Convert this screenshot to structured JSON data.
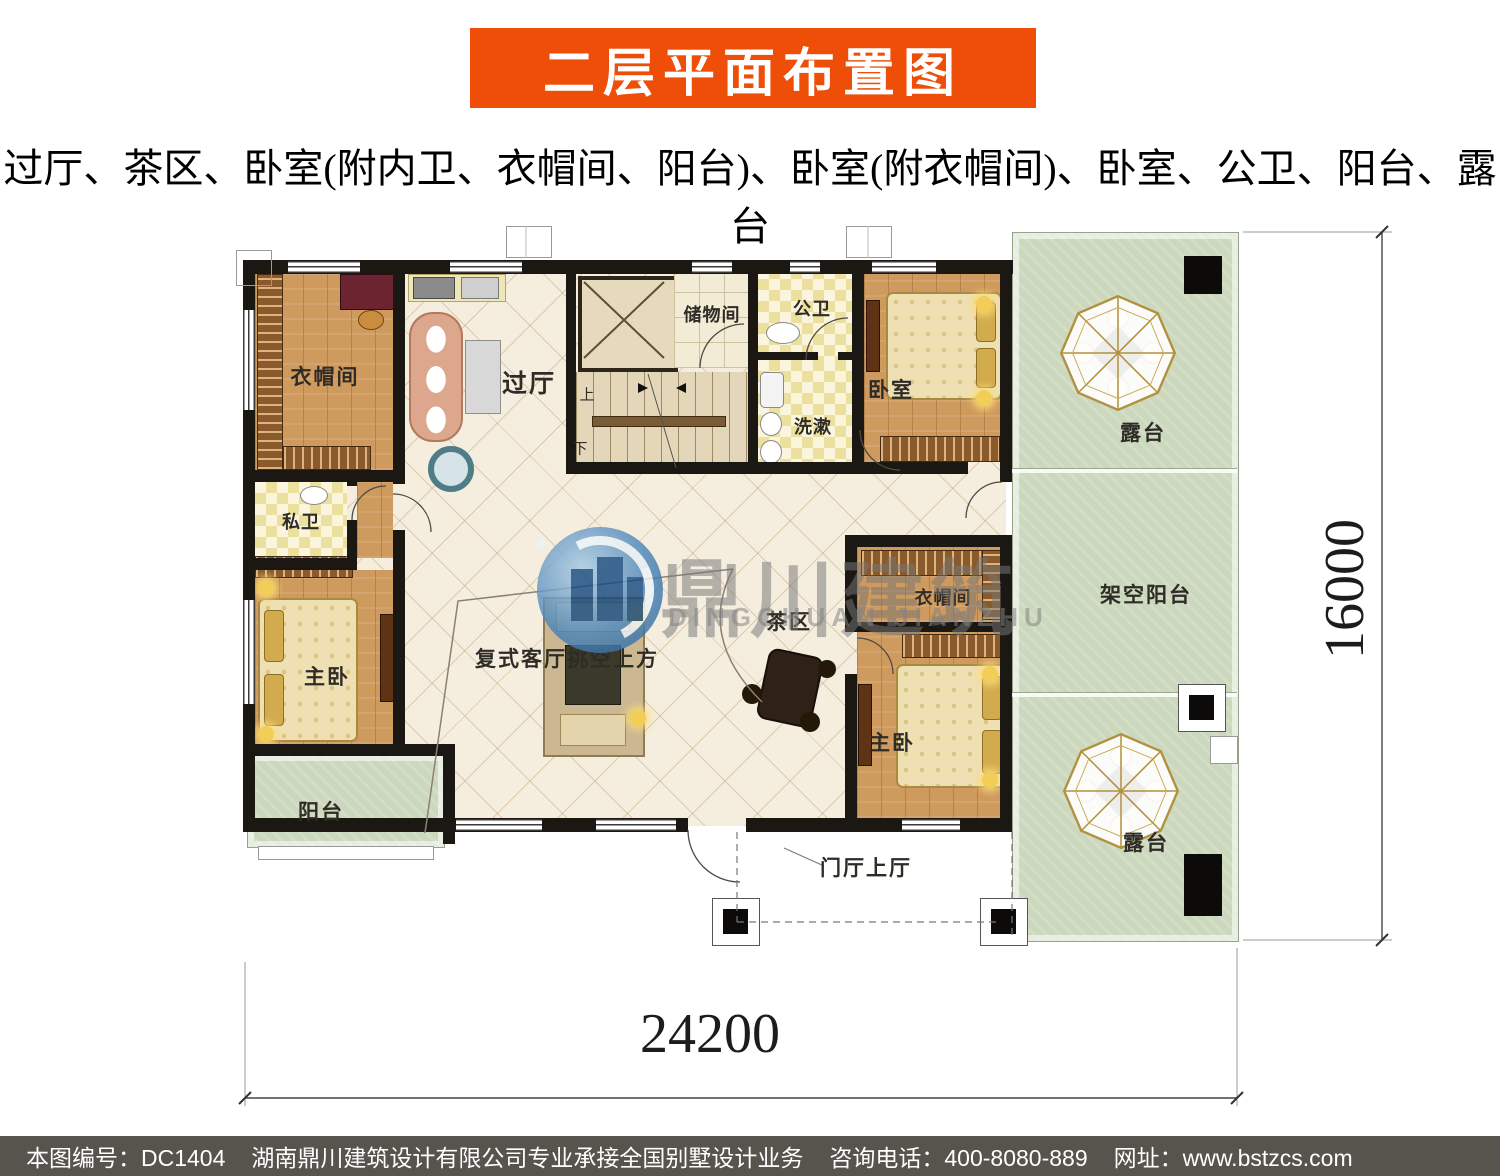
{
  "header": {
    "title": "二层平面布置图",
    "subtitle": "过厅、茶区、卧室(附内卫、衣帽间、阳台)、卧室(附衣帽间)、卧室、公卫、阳台、露台"
  },
  "plan": {
    "labels": {
      "cloakroom_tl": "衣帽间",
      "private_bath": "私卫",
      "master_left": "主卧",
      "hallway": "过厅",
      "storage": "储物间",
      "public_bath": "公卫",
      "wash": "洗漱",
      "bedroom_tr": "卧室",
      "terrace_top": "露台",
      "tea": "茶区",
      "void": "复式客厅挑空上方",
      "cloakroom_r": "衣帽间",
      "elevated_balcony": "架空阳台",
      "master_right": "主卧",
      "balcony": "阳台",
      "terrace_bottom": "露台",
      "entry_hall": "门厅上厅",
      "stair_up": "上",
      "stair_down": "下"
    },
    "dimensions": {
      "width_mm": "24200",
      "height_mm": "16000"
    }
  },
  "watermark": {
    "cn": "鼎川建筑",
    "en": "DINGCHUAN JIANZHU"
  },
  "footer": {
    "code": "本图编号：DC1404",
    "company": "湖南鼎川建筑设计有限公司专业承接全国别墅设计业务",
    "phone": "咨询电话：400-8080-889",
    "website": "网址：www.bstzcs.com"
  },
  "colors": {
    "banner": "#ee4e08",
    "footer_bg": "#57534d",
    "terrace_green": "#cbd8bd",
    "wood": "#cf9a5d",
    "wall": "#1b1713"
  }
}
